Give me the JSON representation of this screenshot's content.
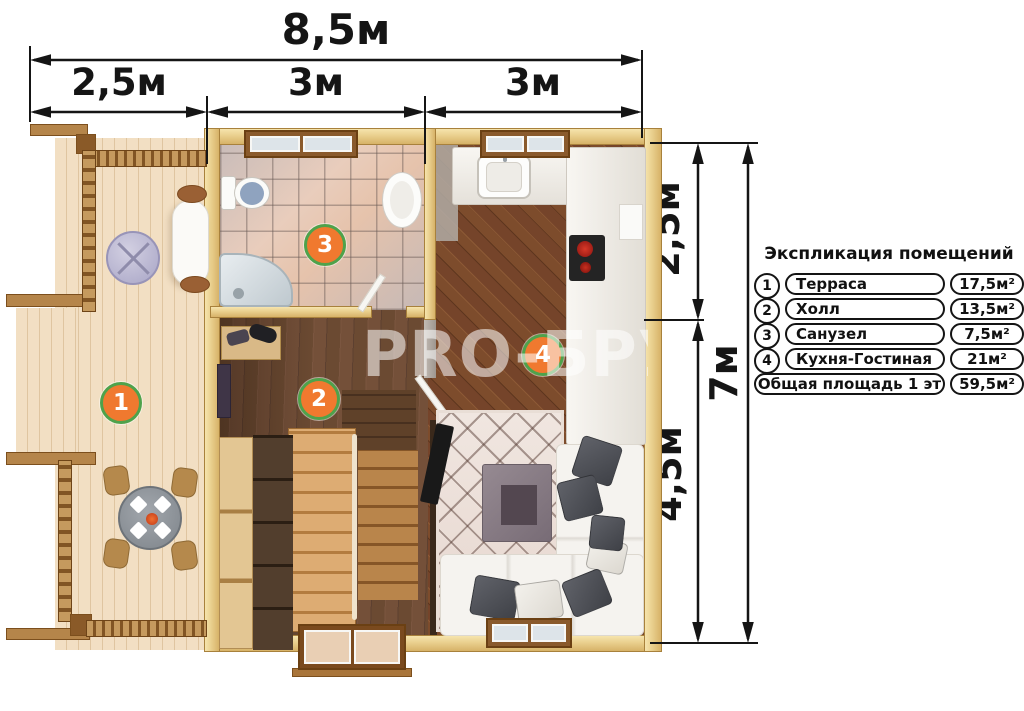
{
  "dimensions": {
    "top_total": "8,5м",
    "top_seg1": "2,5м",
    "top_seg2": "3м",
    "top_seg3": "3м",
    "right_seg1": "2,5м",
    "right_seg2": "4,5м",
    "right_total": "7м"
  },
  "legend": {
    "title": "Экспликация помещений",
    "rows": [
      {
        "num": "1",
        "name": "Терраса",
        "area": "17,5м²"
      },
      {
        "num": "2",
        "name": "Холл",
        "area": "13,5м²"
      },
      {
        "num": "3",
        "name": "Санузел",
        "area": "7,5м²"
      },
      {
        "num": "4",
        "name": "Кухня-Гостиная",
        "area": "21м²"
      },
      {
        "num": "",
        "name": "Общая площадь 1 эт",
        "area": "59,5м²"
      }
    ]
  },
  "plan": {
    "badges": [
      {
        "num": "1"
      },
      {
        "num": "2"
      },
      {
        "num": "3"
      },
      {
        "num": "4"
      }
    ]
  },
  "watermark": "PRO-БРУС",
  "colors": {
    "badge_fill": "#f0792f",
    "badge_border": "#4fa24b",
    "dimension_ink": "#151515"
  }
}
